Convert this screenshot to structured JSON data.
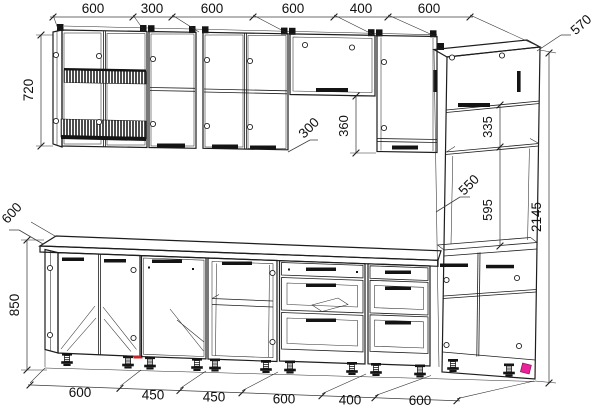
{
  "drawing": {
    "kind": "kitchen-cabinet-assembly-wireframe",
    "colors": {
      "line": "#1d1d1d",
      "background": "#ffffff",
      "marker_pink": "#e8239b",
      "marker_red": "#c9252b"
    },
    "dimensions": {
      "top": [
        "600",
        "300",
        "600",
        "600",
        "400",
        "600"
      ],
      "bottom": [
        "600",
        "450",
        "450",
        "600",
        "400",
        "600"
      ],
      "left": {
        "wall_cabinet_height": "720",
        "countertop_depth": "600",
        "base_height": "850"
      },
      "right": {
        "tall_cabinet_depth": "570",
        "total_height": "2145"
      },
      "internal": {
        "wall_cabinet_depth": "300",
        "flip_cabinet_height": "360",
        "upper_niche_height": "335",
        "niche_width": "550",
        "lower_niche_height": "595"
      }
    }
  }
}
